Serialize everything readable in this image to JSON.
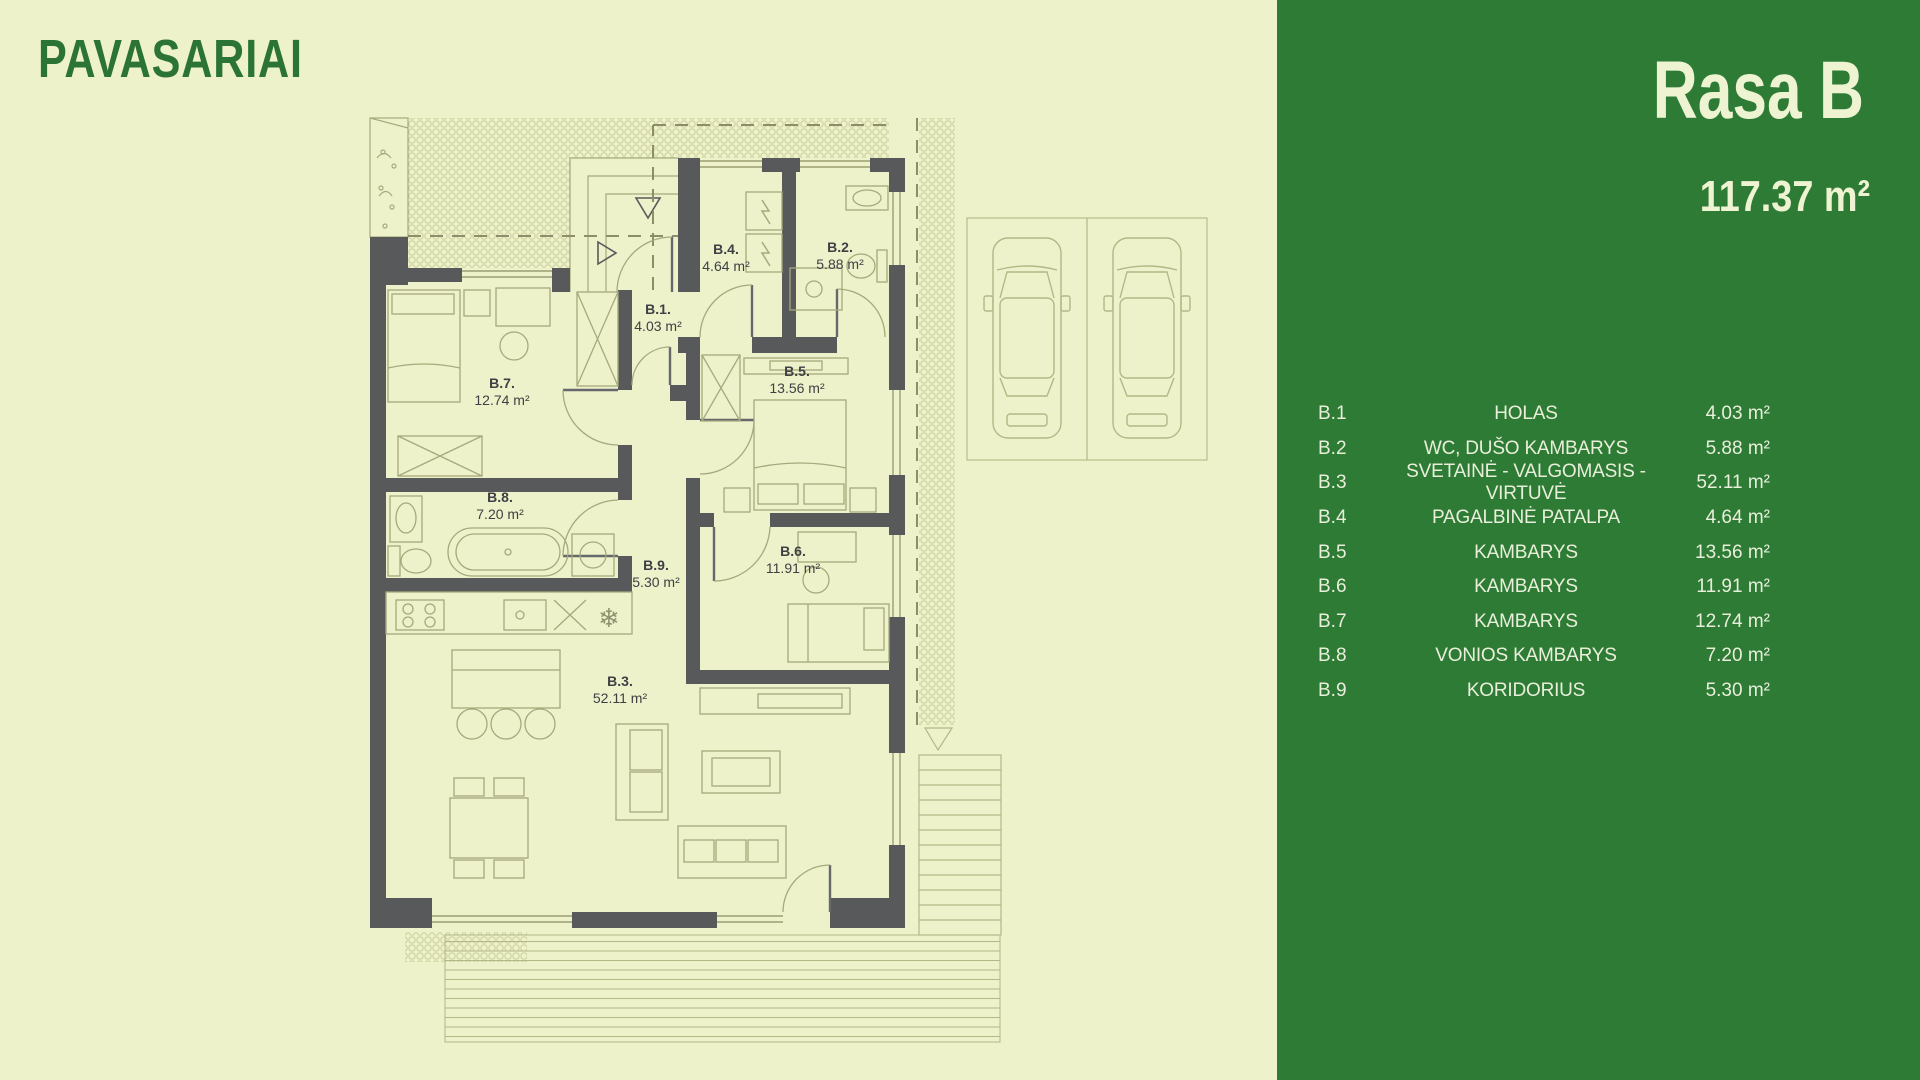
{
  "brand": {
    "logo_text": "PAVASARIAI"
  },
  "unit": {
    "title": "Rasa B",
    "total_area": "117.37 m²"
  },
  "rooms": [
    {
      "code": "B.1",
      "plan_code": "B.1.",
      "name": "HOLAS",
      "area": "4.03 m²",
      "label_x": 658,
      "label_y": 318
    },
    {
      "code": "B.2",
      "plan_code": "B.2.",
      "name": "WC, DUŠO KAMBARYS",
      "area": "5.88 m²",
      "label_x": 840,
      "label_y": 256
    },
    {
      "code": "B.3",
      "plan_code": "B.3.",
      "name": "SVETAINĖ - VALGOMASIS - VIRTUVĖ",
      "area": "52.11 m²",
      "label_x": 620,
      "label_y": 690
    },
    {
      "code": "B.4",
      "plan_code": "B.4.",
      "name": "PAGALBINĖ PATALPA",
      "area": "4.64 m²",
      "label_x": 726,
      "label_y": 258
    },
    {
      "code": "B.5",
      "plan_code": "B.5.",
      "name": "KAMBARYS",
      "area": "13.56 m²",
      "label_x": 797,
      "label_y": 380
    },
    {
      "code": "B.6",
      "plan_code": "B.6.",
      "name": "KAMBARYS",
      "area": "11.91 m²",
      "label_x": 793,
      "label_y": 560
    },
    {
      "code": "B.7",
      "plan_code": "B.7.",
      "name": "KAMBARYS",
      "area": "12.74 m²",
      "label_x": 502,
      "label_y": 392
    },
    {
      "code": "B.8",
      "plan_code": "B.8.",
      "name": "VONIOS KAMBARYS",
      "area": "7.20 m²",
      "label_x": 500,
      "label_y": 506
    },
    {
      "code": "B.9",
      "plan_code": "B.9.",
      "name": "KORIDORIUS",
      "area": "5.30 m²",
      "label_x": 656,
      "label_y": 574
    }
  ],
  "icons": {
    "snowflake": "❄"
  },
  "colors": {
    "background": "#edf2cb",
    "panel_green": "#2d7b35",
    "logo_green": "#2b7435",
    "cream_text": "#eef3d2",
    "wall_gray": "#58595b",
    "plan_line_olive": "#a6a97b"
  }
}
